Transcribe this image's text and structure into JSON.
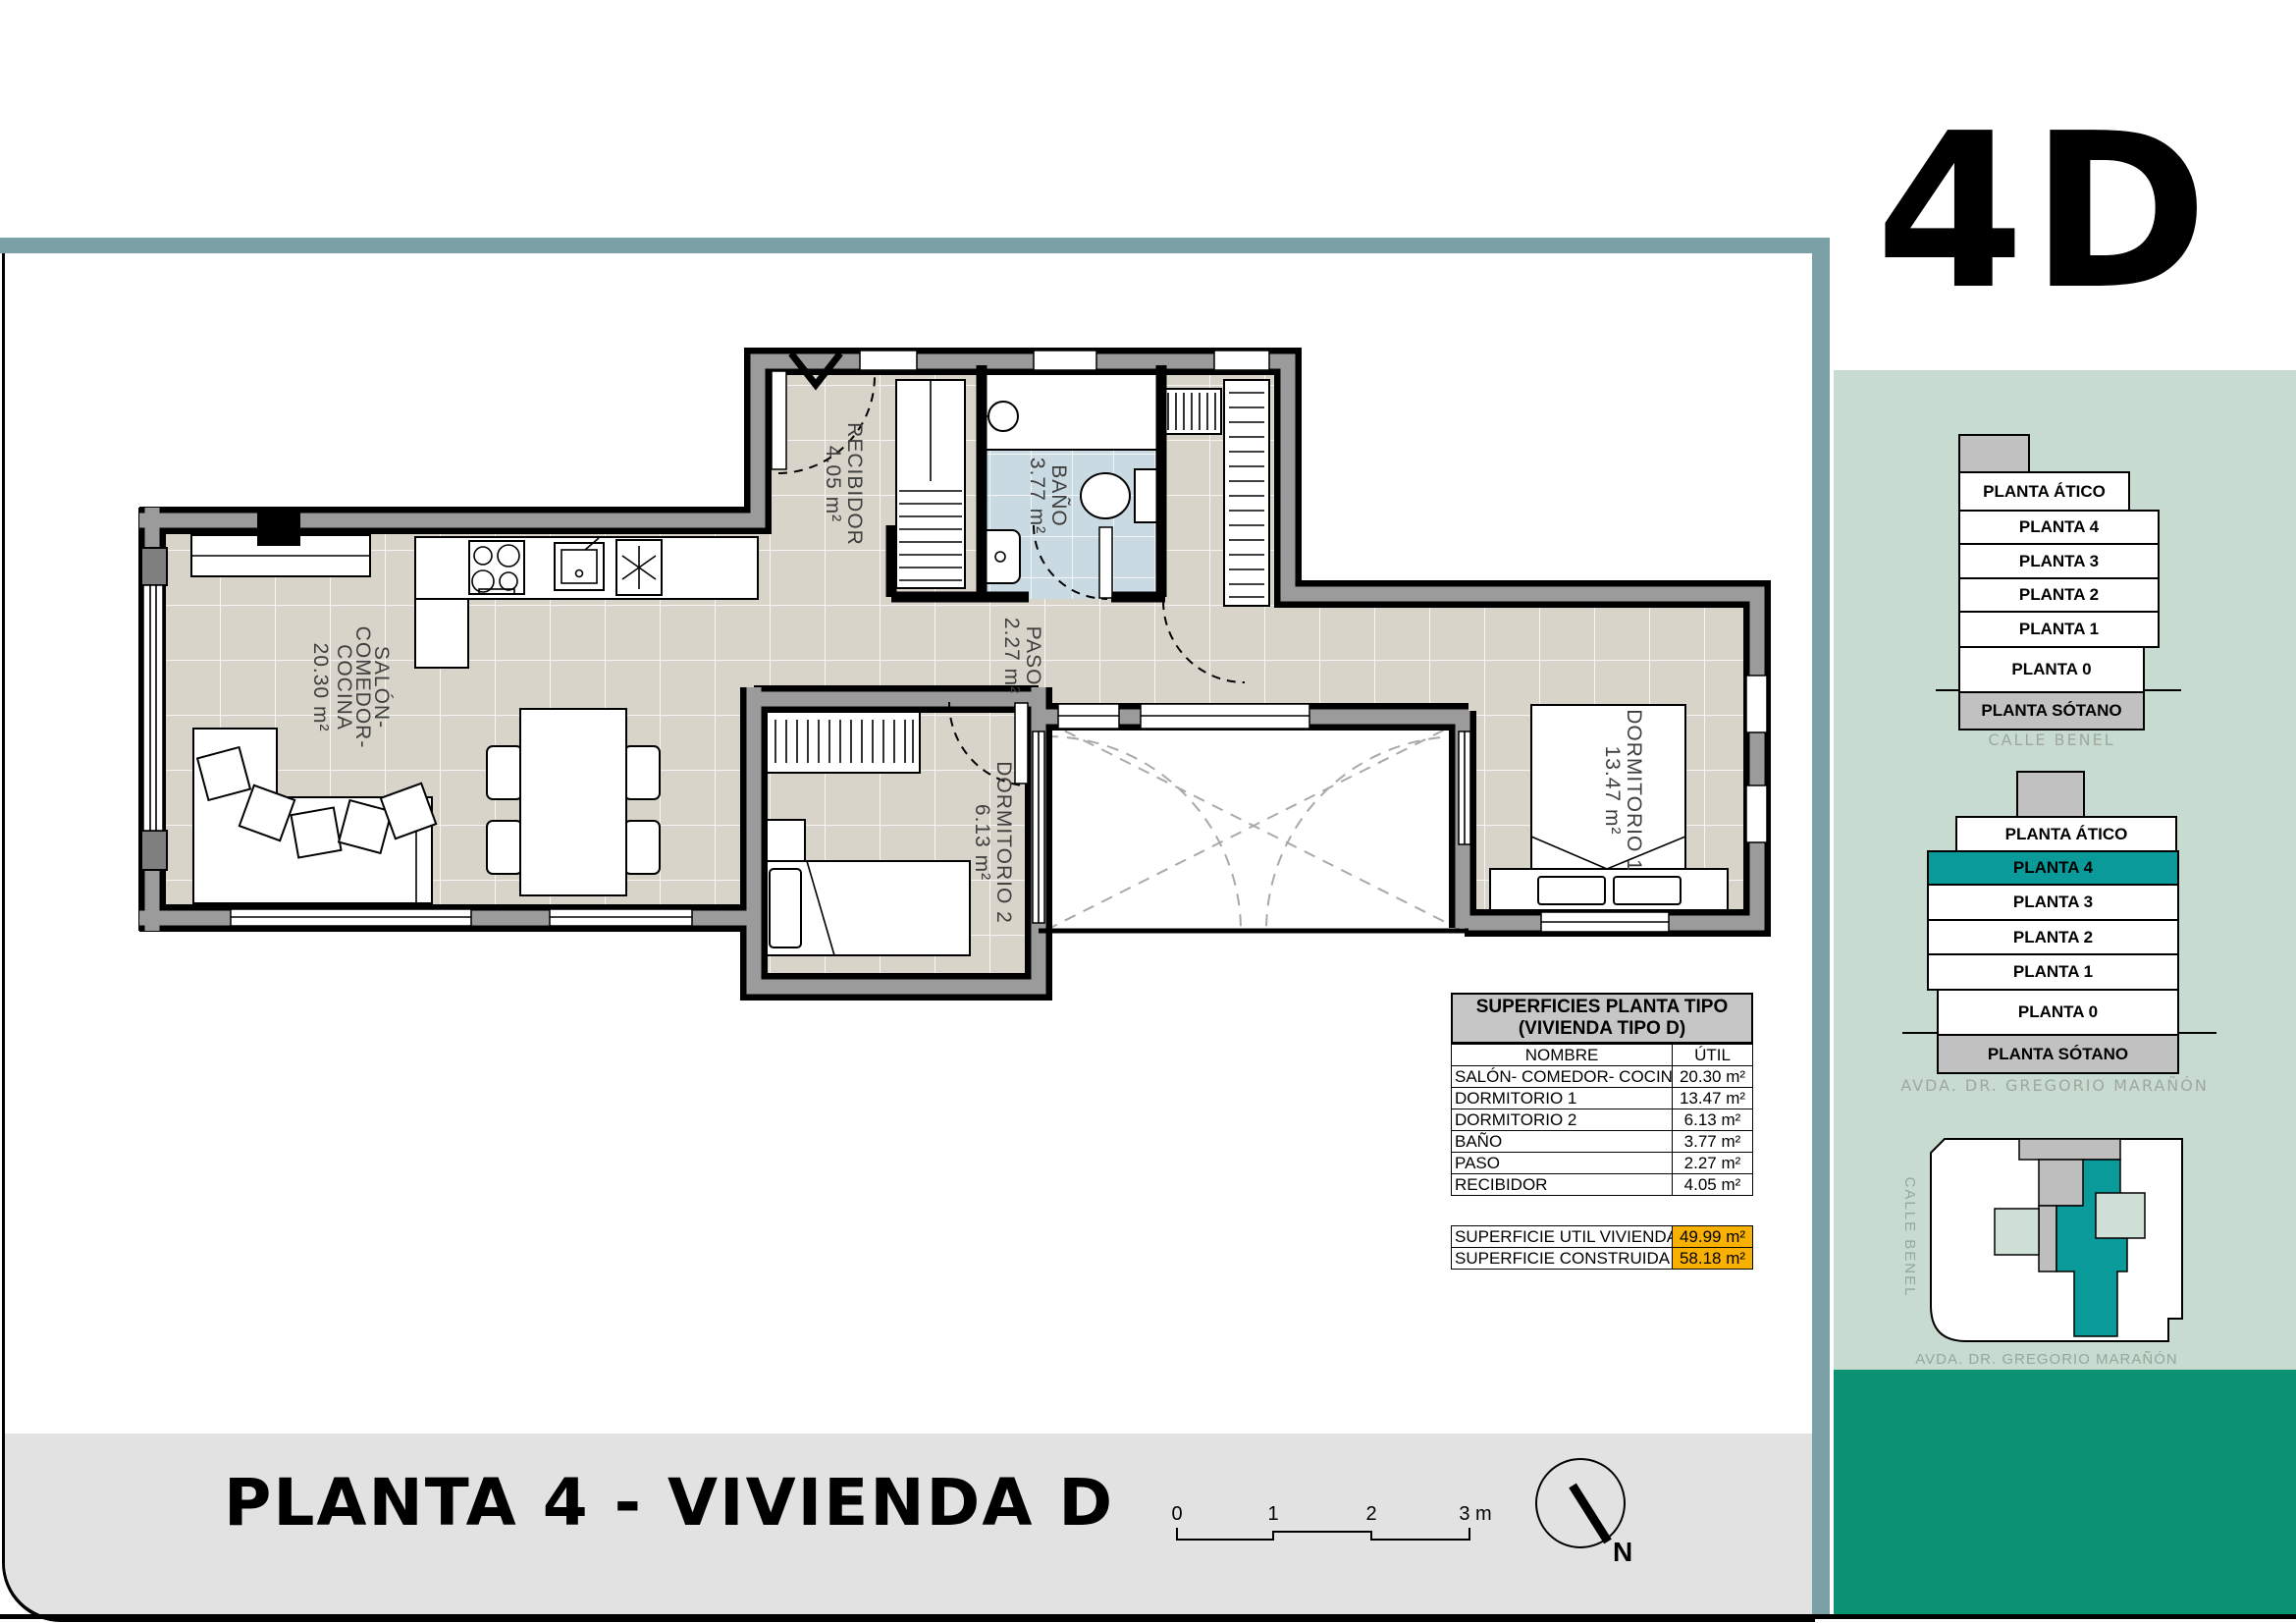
{
  "logo": "4D",
  "sidebar": {
    "stack_top": {
      "floors": [
        "PLANTA ÁTICO",
        "PLANTA 4",
        "PLANTA 3",
        "PLANTA 2",
        "PLANTA 1",
        "PLANTA 0",
        "PLANTA SÓTANO"
      ],
      "caption": "CALLE BENEL"
    },
    "stack_bottom": {
      "floors": [
        "PLANTA ÁTICO",
        "PLANTA 4",
        "PLANTA 3",
        "PLANTA 2",
        "PLANTA 1",
        "PLANTA 0",
        "PLANTA SÓTANO"
      ],
      "highlighted_floor": "PLANTA 4",
      "caption": "AVDA. DR. GREGORIO MARAÑÓN"
    },
    "siteplan": {
      "street_left": "CALLE BENEL",
      "street_bottom": "AVDA. DR. GREGORIO MARAÑÓN"
    }
  },
  "table": {
    "title_line1": "SUPERFICIES PLANTA TIPO",
    "title_line2": "(VIVIENDA TIPO D)",
    "col_name": "NOMBRE",
    "col_util": "ÚTIL",
    "rows": [
      {
        "name": "SALÓN- COMEDOR- COCINA",
        "value": "20.30 m²"
      },
      {
        "name": "DORMITORIO 1",
        "value": "13.47 m²"
      },
      {
        "name": "DORMITORIO 2",
        "value": "6.13 m²"
      },
      {
        "name": "BAÑO",
        "value": "3.77 m²"
      },
      {
        "name": "PASO",
        "value": "2.27 m²"
      },
      {
        "name": "RECIBIDOR",
        "value": "4.05 m²"
      }
    ],
    "summary": [
      {
        "name": "SUPERFICIE UTIL VIVIENDA",
        "value": "49.99 m²"
      },
      {
        "name": "SUPERFICIE CONSTRUIDA",
        "value": "58.18 m²"
      }
    ]
  },
  "floor_plan": {
    "salon": {
      "lines": [
        "SALÓN-",
        "COMEDOR-",
        "COCINA"
      ],
      "area": "20.30 m²"
    },
    "recibidor": {
      "name": "RECIBIDOR",
      "area": "4.05 m²"
    },
    "bano": {
      "name": "BAÑO",
      "area": "3.77 m²"
    },
    "paso": {
      "name": "PASO",
      "area": "2.27 m²"
    },
    "dorm1": {
      "name": "DORMITORIO 1",
      "area": "13.47 m²"
    },
    "dorm2": {
      "name": "DORMITORIO 2",
      "area": "6.13 m²"
    }
  },
  "footer": {
    "title": "PLANTA 4 - VIVIENDA D",
    "scale_labels": [
      "0",
      "1",
      "2",
      "3 m"
    ],
    "north_label": "N"
  },
  "colors": {
    "frame_teal": "#7BA1A6",
    "sidebar_green": "#C8DBD0",
    "band_dark_green": "#0B9273",
    "highlight_teal": "#0A9A9A",
    "orange": "#F8B100",
    "floor_beige": "#D8D4CA",
    "bath_blue": "#C9DAE3",
    "wall_gray": "#9B9B9B"
  }
}
